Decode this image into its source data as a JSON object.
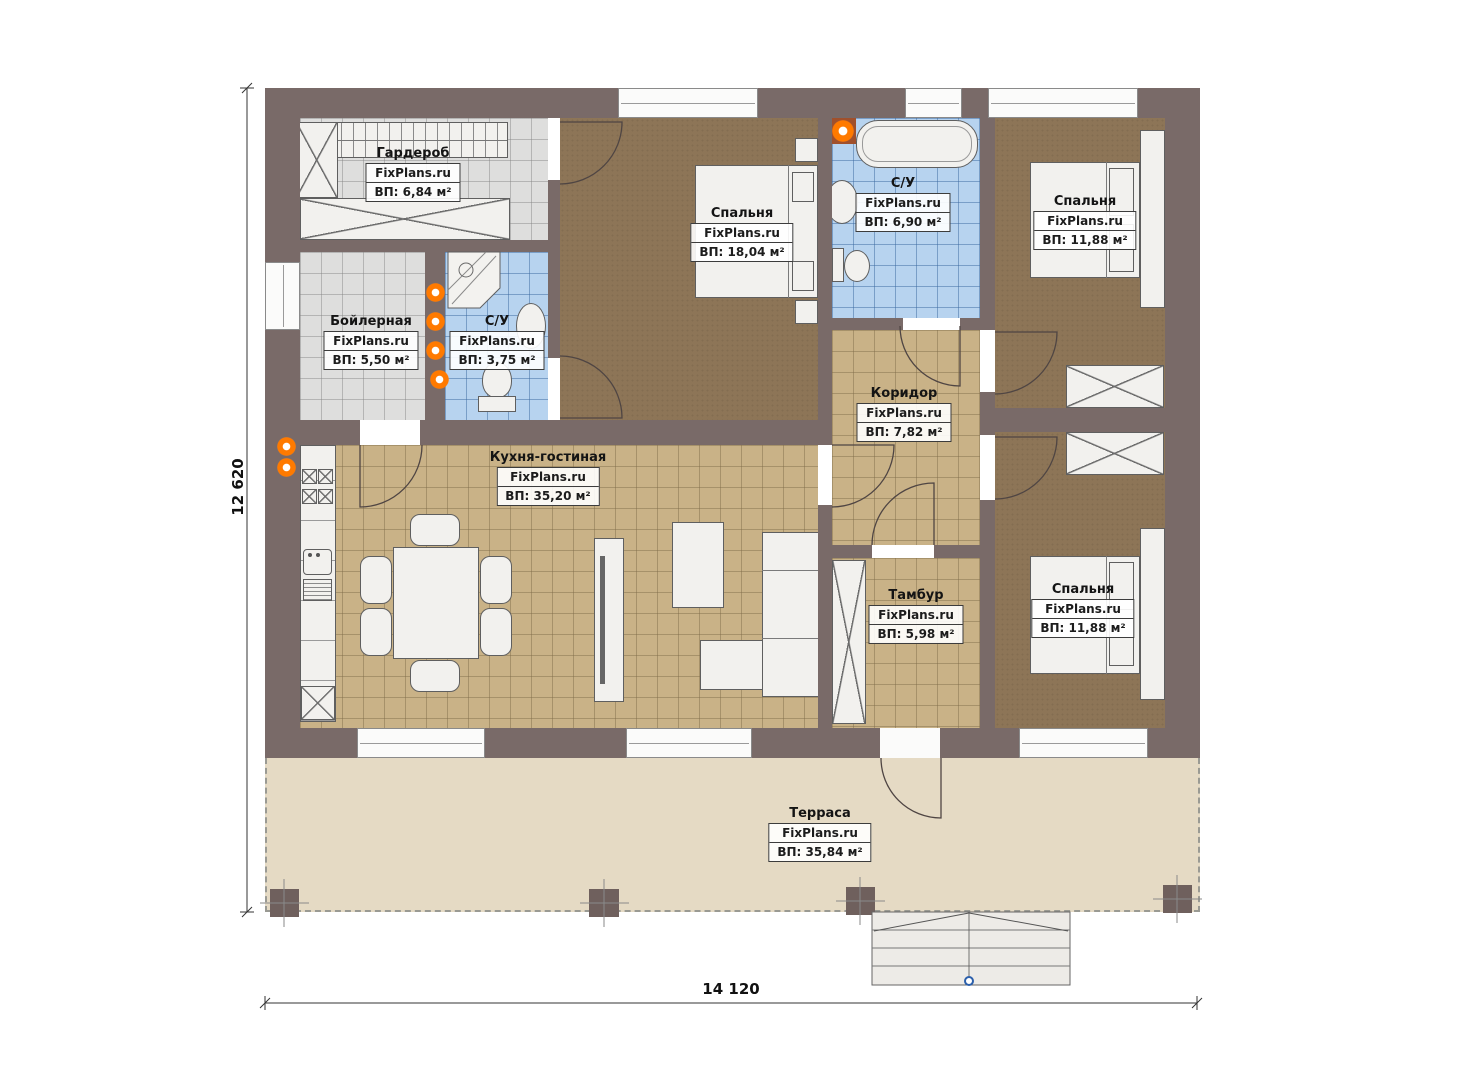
{
  "plan": {
    "brand": "FixPlans.ru",
    "rooms": [
      {
        "id": "wardrobe",
        "name": "Гардероб",
        "area": "ВП: 6,84 м²"
      },
      {
        "id": "boiler",
        "name": "Бойлерная",
        "area": "ВП: 5,50 м²"
      },
      {
        "id": "bath-small",
        "name": "С/У",
        "area": "ВП: 3,75 м²"
      },
      {
        "id": "bedroom-main",
        "name": "Спальня",
        "area": "ВП: 18,04 м²"
      },
      {
        "id": "bath",
        "name": "С/У",
        "area": "ВП: 6,90 м²"
      },
      {
        "id": "bedroom-right-top",
        "name": "Спальня",
        "area": "ВП: 11,88 м²"
      },
      {
        "id": "corridor",
        "name": "Коридор",
        "area": "ВП: 7,82 м²"
      },
      {
        "id": "kitchen-living",
        "name": "Кухня-гостиная",
        "area": "ВП: 35,20 м²"
      },
      {
        "id": "vestibule",
        "name": "Тамбур",
        "area": "ВП: 5,98 м²"
      },
      {
        "id": "bedroom-right-bottom",
        "name": "Спальня",
        "area": "ВП: 11,88 м²"
      },
      {
        "id": "terrace",
        "name": "Терраса",
        "area": "ВП: 35,84 м²"
      }
    ],
    "dimensions": {
      "height_label": "12 620",
      "width_label": "14 120"
    },
    "colors": {
      "wall": "#796a68",
      "bedroom_floor": "#8d7557",
      "tile_tan": "#c9b287",
      "tile_blue": "#b7d3ef",
      "tile_gray": "#dededd",
      "terrace": "#e5dac4",
      "heat_orange": "#ff7a00",
      "step_marker_blue": "#2b5fab"
    }
  }
}
